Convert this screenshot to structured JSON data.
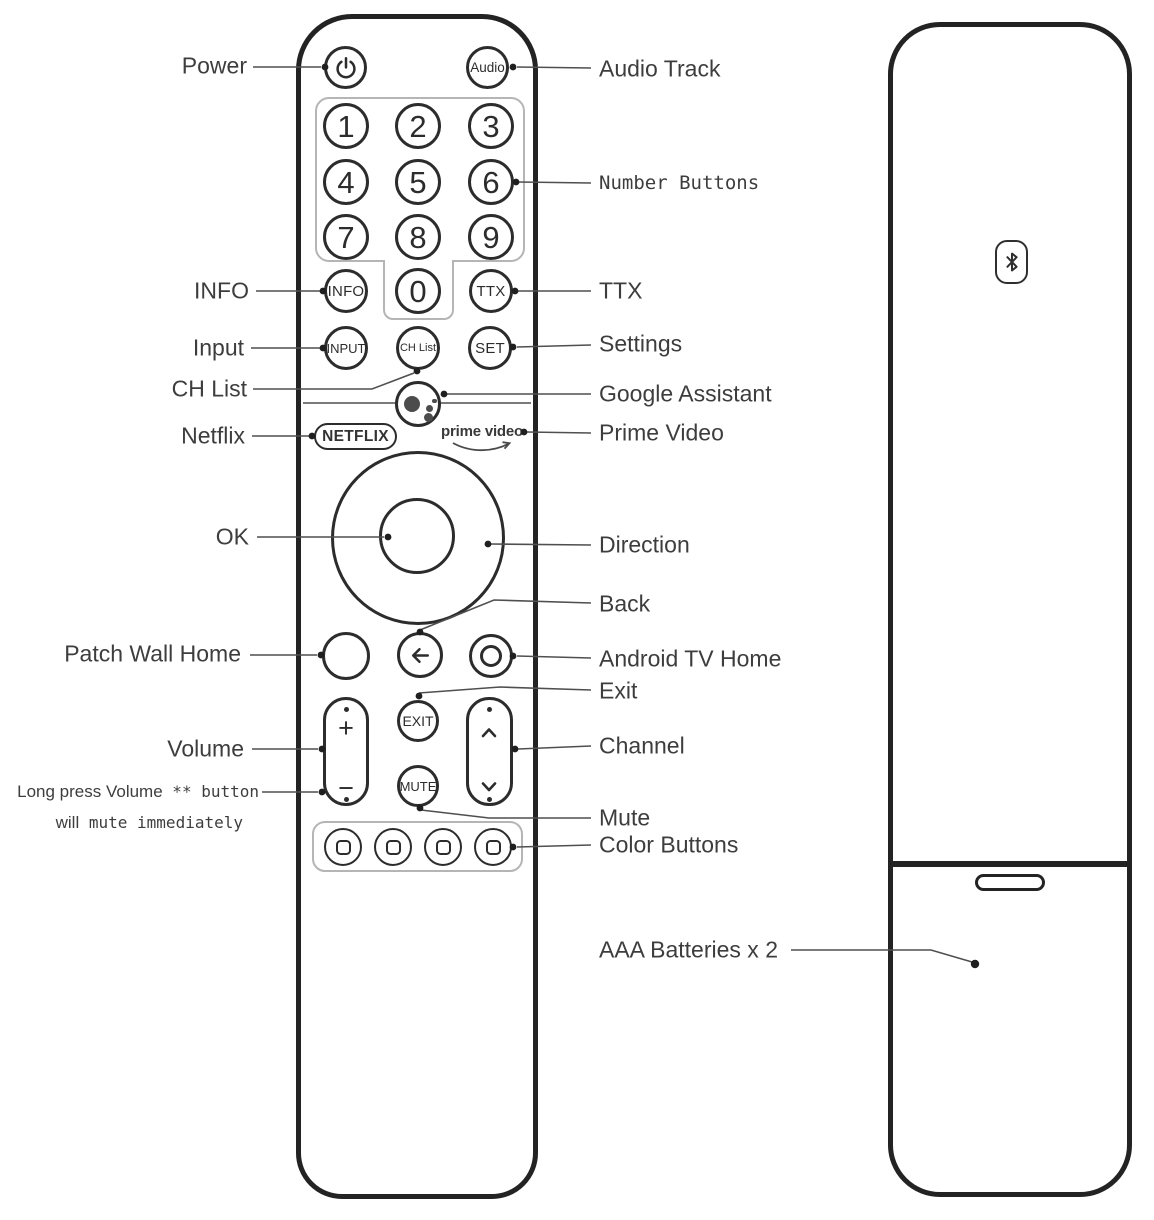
{
  "front": {
    "audio": "Audio",
    "digits": [
      "1",
      "2",
      "3",
      "4",
      "5",
      "6",
      "7",
      "8",
      "9"
    ],
    "zero": "0",
    "info": "INFO",
    "ttx": "TTX",
    "input": "INPUT",
    "ch_list": "CH List",
    "set": "SET",
    "netflix": "NETFLIX",
    "prime_video": "prime video",
    "exit": "EXIT",
    "mute": "MUTE",
    "volume_plus": "+",
    "volume_minus": "−"
  },
  "labels_left": {
    "power": "Power",
    "info": "INFO",
    "input": "Input",
    "ch_list": "CH List",
    "netflix": "Netflix",
    "ok": "OK",
    "patch_wall_home": "Patch Wall Home",
    "volume": "Volume",
    "note1_sans": "Long press Volume",
    "note1_mono": " ** button",
    "note2_sans": "will",
    "note2_mono": " mute immediately"
  },
  "labels_right": {
    "audio_track": "Audio Track",
    "number_buttons": "Number Buttons",
    "ttx": "TTX",
    "settings": "Settings",
    "google_assistant": "Google Assistant",
    "prime_video": "Prime Video",
    "direction": "Direction",
    "back": "Back",
    "android_tv_home": "Android TV Home",
    "exit": "Exit",
    "channel": "Channel",
    "mute": "Mute",
    "color_buttons": "Color Buttons",
    "aaa_batteries": "AAA Batteries x 2"
  },
  "icons": {
    "power": "power-icon",
    "back": "back-arrow-icon",
    "android_home": "ring-icon",
    "google_assistant": "google-assistant-dots-icon",
    "bluetooth": "bluetooth-icon",
    "channel_up": "chevron-up-icon",
    "channel_down": "chevron-down-icon",
    "prime_swoosh": "smile-arrow-icon"
  },
  "colors": {
    "ink": "#2c2c2c",
    "line": "#4f4f4f",
    "label": "#3d3d3d",
    "soft_outline": "#b5b5b5"
  }
}
